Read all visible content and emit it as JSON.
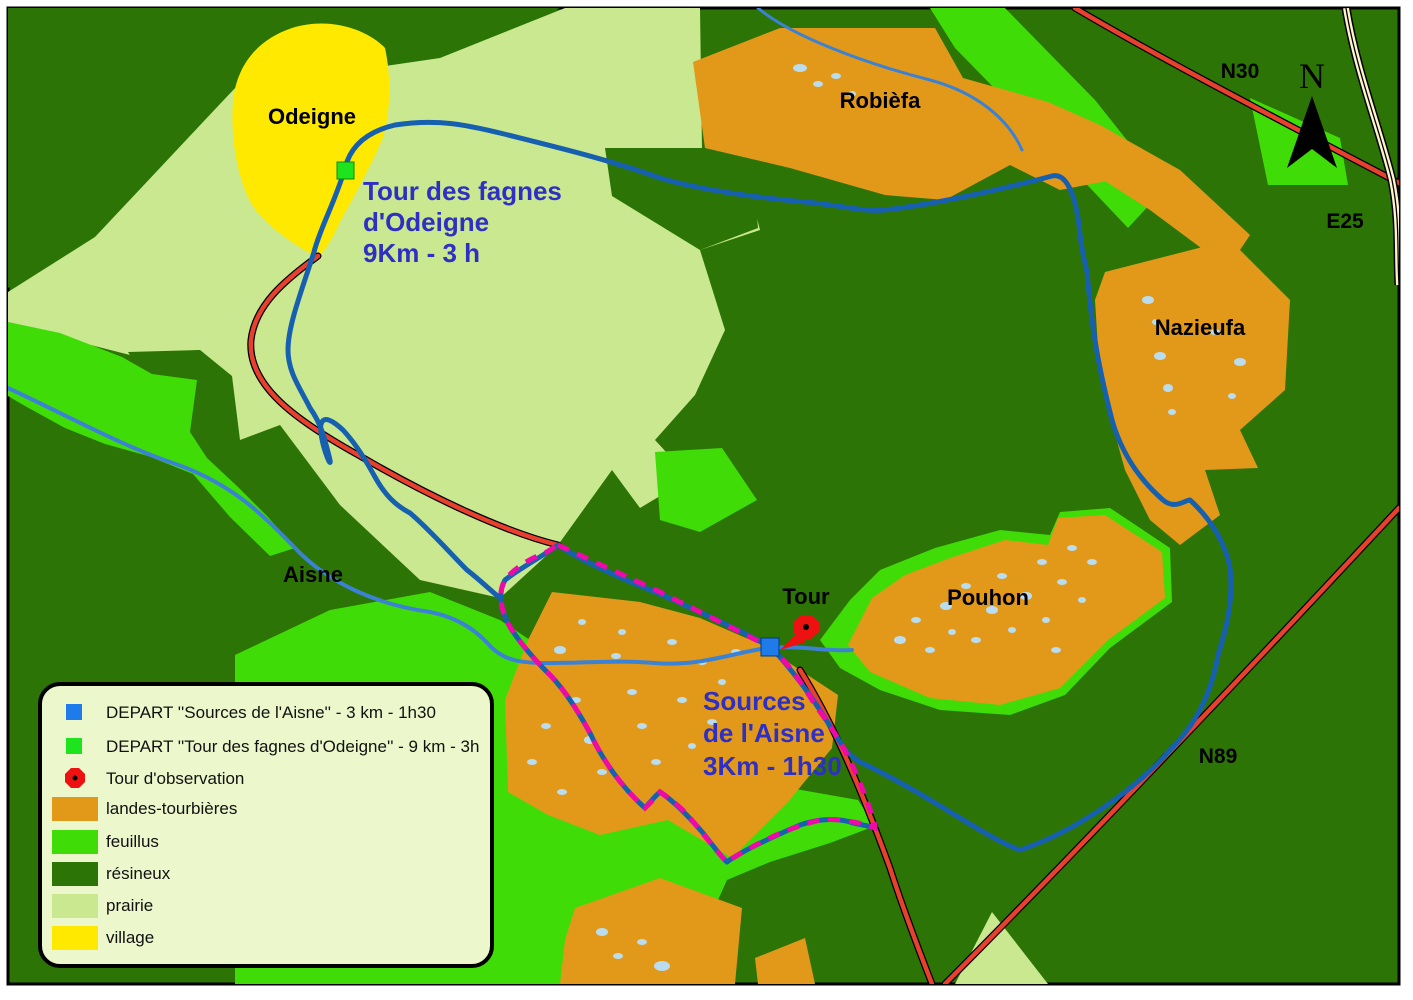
{
  "colors": {
    "resineux": "#2b7405",
    "feuillus": "#3fdc08",
    "prairie": "#c9e890",
    "village": "#ffe900",
    "landes_tourbieres": "#e2991a",
    "pond": "#b9dcef",
    "river": "#3b82d4",
    "route": "#1760b0",
    "road": "#e8402f",
    "motorway_fill": "#fdf3cf",
    "boundary": "#ee09a8",
    "depart_sources_marker": "#1f7bea",
    "depart_odeigne_marker": "#1ee41e",
    "tower_marker": "#ee1111",
    "route_label": "#2f2fc4",
    "legend_bg": "#ecf7cc"
  },
  "places": {
    "odeigne": "Odeigne",
    "robiefa": "Robièfa",
    "nazieufa": "Nazieufa",
    "pouhon": "Pouhon",
    "tour": "Tour"
  },
  "water": {
    "river_label": "Aisne"
  },
  "roads": {
    "n30": "N30",
    "e25": "E25",
    "n89": "N89"
  },
  "trails": {
    "odeigne": {
      "line1": "Tour des fagnes",
      "line2": "d'Odeigne",
      "line3": "9Km - 3 h"
    },
    "sources": {
      "line1": "Sources",
      "line2": "de l'Aisne",
      "line3": "3Km - 1h30"
    }
  },
  "compass": {
    "north": "N"
  },
  "legend": {
    "items": [
      {
        "type": "square",
        "color_key": "depart_sources_marker",
        "label": "DEPART ''Sources de l'Aisne'' - 3 km - 1h30"
      },
      {
        "type": "square",
        "color_key": "depart_odeigne_marker",
        "label": "DEPART ''Tour des fagnes d'Odeigne'' - 9 km - 3h"
      },
      {
        "type": "tower",
        "color_key": "tower_marker",
        "label": "Tour d'observation"
      },
      {
        "type": "area",
        "color_key": "landes_tourbieres",
        "label": "landes-tourbières"
      },
      {
        "type": "area",
        "color_key": "feuillus",
        "label": "feuillus"
      },
      {
        "type": "area",
        "color_key": "resineux",
        "label": "résineux"
      },
      {
        "type": "area",
        "color_key": "prairie",
        "label": "prairie"
      },
      {
        "type": "area",
        "color_key": "village",
        "label": "village"
      }
    ]
  }
}
